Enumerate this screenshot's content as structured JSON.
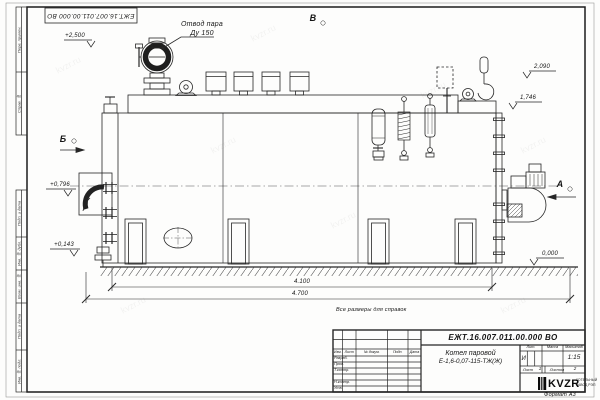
{
  "page": {
    "watermark": "kvzr.ru",
    "format_label": "Формат А3",
    "reference_note": "Все размеры для справок"
  },
  "frame": {
    "top_labels": [
      "Перв. примен.",
      "Справ. №"
    ],
    "bottom_labels": [
      "Подп. и дата",
      "Инв. № дубл.",
      "Взам. инв. №",
      "Подп. и дата",
      "Инв. № подл."
    ]
  },
  "inverted_stamp": {
    "doc_number": "ЕЖТ.16.007.011.00.000  ВО"
  },
  "drawing": {
    "labels": {
      "steam_outlet_line1": "Отвод пара",
      "steam_outlet_line2": "Ду 150",
      "view_b_top": "В",
      "view_b_left": "Б",
      "view_a_right": "А"
    },
    "elevations": {
      "steam_valve": "+2,500",
      "rear_top": "2,090",
      "rear_mid": "1,746",
      "burner_axis": "+0,796",
      "front_low": "+0,143",
      "ground": "0,000"
    },
    "dimensions": {
      "body_length": "4.100",
      "overall_length": "4.700"
    }
  },
  "title_block": {
    "doc_number": "ЕЖТ.16.007.011.00.000  ВО",
    "product_name_line1": "Котел паровой",
    "product_name_line2": "Е-1,6-0,07-115-ТЖ(Ж)",
    "header_cells": [
      "Изм.",
      "Лист",
      "№ докум.",
      "Подп.",
      "Дата"
    ],
    "signature_rows": [
      "Разраб.",
      "Пров.",
      "Т.контр.",
      "Н.контр.",
      "Утв."
    ],
    "lit_label": "Лит.",
    "lit_value": "И",
    "mass_label": "Масса",
    "scale_label": "Масштаб",
    "scale_value": "1:15",
    "sheet_label": "Лист",
    "sheet_value": "1",
    "sheets_label": "Листов",
    "sheets_value": "2",
    "logo_text": "KVZR",
    "logo_caption_line1": "КОТЕЛЬНЫЙ",
    "logo_caption_line2": "ЗАВОД РЭП"
  }
}
